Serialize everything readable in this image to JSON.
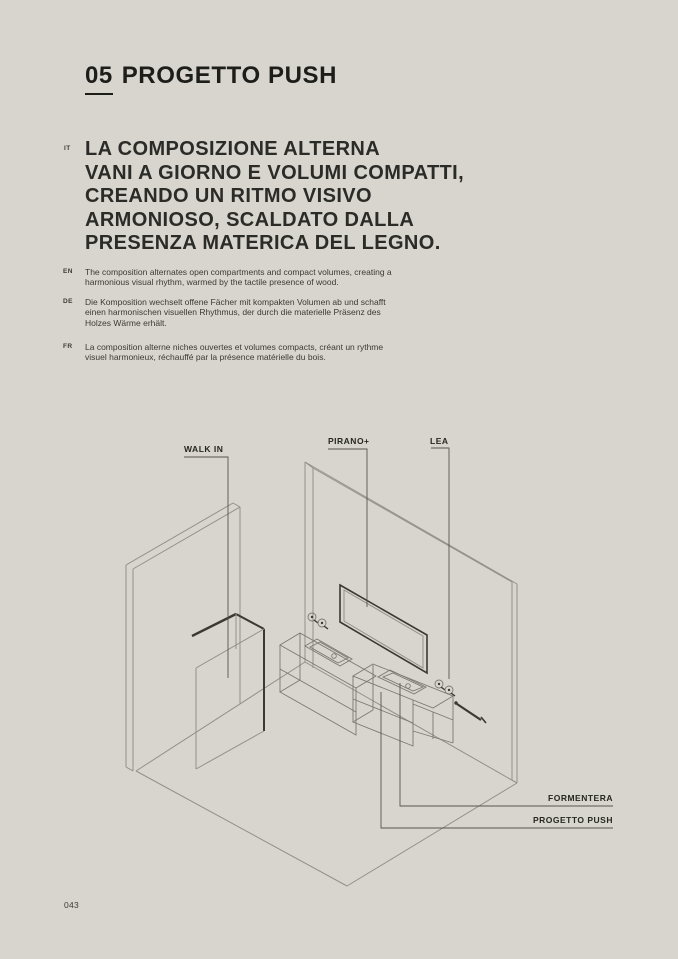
{
  "header": {
    "index": "05",
    "title": "PROGETTO PUSH"
  },
  "intro": {
    "lang": "IT",
    "text": "LA COMPOSIZIONE ALTERNA\nVANI A GIORNO E VOLUMI COMPATTI,\nCREANDO UN RITMO VISIVO\nARMONIOSO, SCALDATO DALLA\nPRESENZA MATERICA DEL LEGNO."
  },
  "translations": [
    {
      "lang": "EN",
      "text": "The composition alternates open compartments and compact volumes, creating a harmonious visual rhythm, warmed by the tactile presence of wood."
    },
    {
      "lang": "DE",
      "text": "Die Komposition wechselt offene Fächer mit kompakten Volumen ab und schafft einen harmonischen visuellen Rhythmus, der durch die materielle Präsenz des Holzes Wärme erhält."
    },
    {
      "lang": "FR",
      "text": "La composition alterne niches ouvertes et volumes compacts, créant un rythme visuel harmonieux, réchauffé par la présence matérielle du bois."
    }
  ],
  "diagram": {
    "labels": {
      "walk_in": "WALK IN",
      "pirano": "PIRANO+",
      "lea": "LEA",
      "formentera": "FORMENTERA",
      "progetto_push": "PROGETTO PUSH"
    }
  },
  "footer": {
    "page_number": "043"
  },
  "colors": {
    "background": "#d8d5ce",
    "ink": "#1d1d1a",
    "body_text": "#3b3a35",
    "line_light": "#93908a",
    "line_dark": "#3a3934",
    "leader": "#57554f"
  }
}
